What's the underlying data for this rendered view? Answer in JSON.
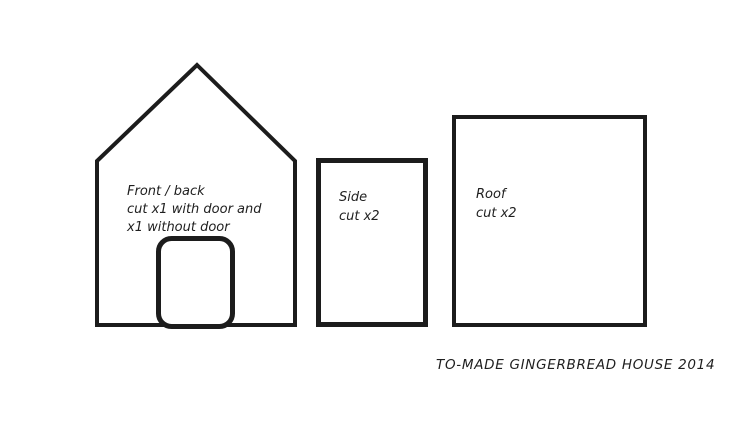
{
  "diagram": {
    "caption": "TO-MADE GINGERBREAD HOUSE 2014",
    "colors": {
      "line": "#1c1c1c",
      "background": "#ffffff",
      "text": "#1f1f1f"
    },
    "pieces": {
      "front_back": {
        "name": "Front / back",
        "instruction_line1": "cut x1 with door and",
        "instruction_line2": "x1 without door"
      },
      "side": {
        "name": "Side",
        "instruction_line1": "cut x2"
      },
      "roof": {
        "name": "Roof",
        "instruction_line1": "cut x2"
      }
    }
  }
}
